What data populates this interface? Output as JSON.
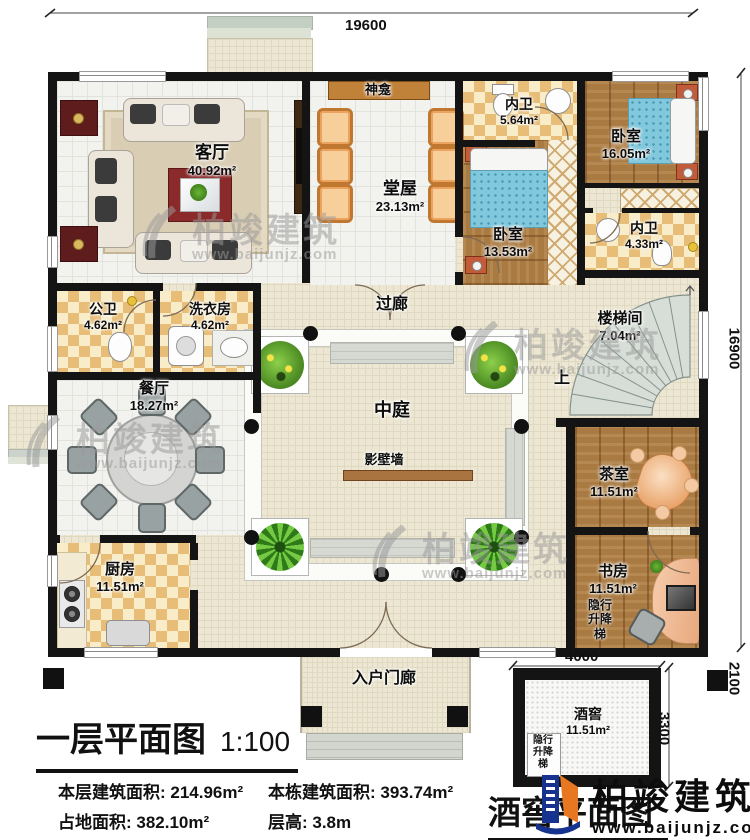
{
  "branding": {
    "watermark": {
      "text": "柏竣建筑",
      "url": "www.baijunjz.com"
    },
    "logo": {
      "text": "柏竣建筑",
      "url": "www.baijunjz.com"
    }
  },
  "dims": {
    "top": "19600",
    "right": "16900",
    "cellar_width": "4000",
    "cellar_height": "3300",
    "cellar_depth": "2100"
  },
  "rooms": {
    "living": {
      "name": "客厅",
      "area": "40.92m²"
    },
    "hall": {
      "name": "堂屋",
      "area": "23.13m²"
    },
    "shrine": {
      "name": "神龛"
    },
    "ensuite_top": {
      "name": "内卫",
      "area": "5.64m²"
    },
    "bedroom_right": {
      "name": "卧室",
      "area": "16.05m²"
    },
    "bedroom_mid": {
      "name": "卧室",
      "area": "13.53m²"
    },
    "ensuite_right": {
      "name": "内卫",
      "area": "4.33m²"
    },
    "public_bath": {
      "name": "公卫",
      "area": "4.62m²"
    },
    "laundry": {
      "name": "洗衣房",
      "area": "4.62m²"
    },
    "corridor": {
      "name": "过廊"
    },
    "stairwell": {
      "name": "楼梯间",
      "area": "7.04m²",
      "up": "上"
    },
    "dining": {
      "name": "餐厅",
      "area": "18.27m²"
    },
    "atrium": {
      "name": "中庭"
    },
    "screen_wall": {
      "name": "影壁墙"
    },
    "kitchen": {
      "name": "厨房",
      "area": "11.51m²"
    },
    "tea_room": {
      "name": "茶室",
      "area": "11.51m²"
    },
    "study": {
      "name": "书房",
      "area": "11.51m²"
    },
    "elevator": {
      "l1": "隐行",
      "l2": "升降",
      "l3": "梯"
    },
    "entry_porch": {
      "name": "入户门廊"
    },
    "cellar": {
      "name": "酒窖",
      "area": "11.51m²"
    }
  },
  "title_block": {
    "title": "一层平面图",
    "scale": "1:100",
    "floor_area": "本层建筑面积: 214.96m²",
    "total_area": "本栋建筑面积: 393.74m²",
    "land_area": "占地面积: 382.10m²",
    "floor_height": "层高: 3.8m",
    "cellar_title": "酒窖平面图"
  }
}
